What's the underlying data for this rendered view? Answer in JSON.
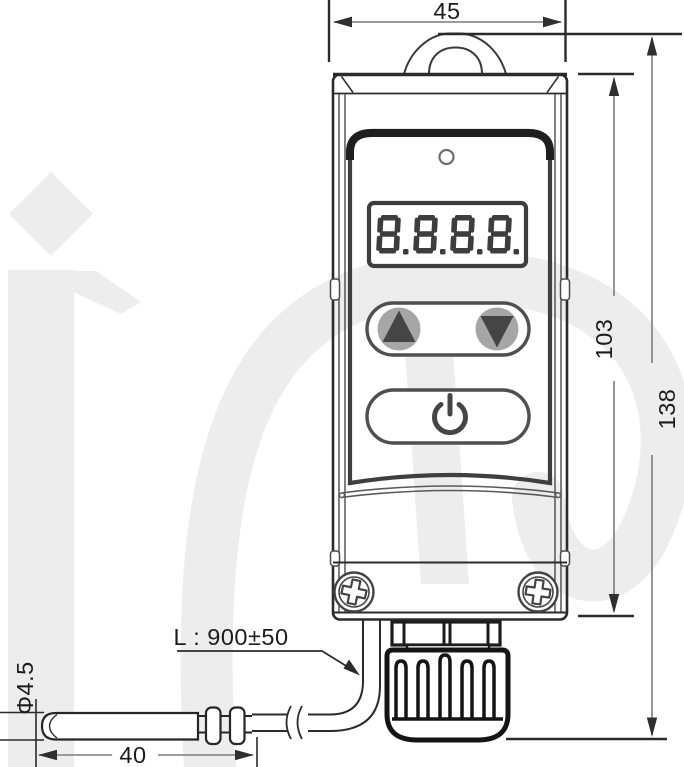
{
  "meta": {
    "type": "technical-dimension-drawing",
    "subject": "digital thermostat with remote sensor probe"
  },
  "dimensions": {
    "width": "45",
    "front_height": "103",
    "total_height": "138",
    "probe_length": "40",
    "probe_diameter": "Φ4.5",
    "cable_length": "L : 900±50"
  },
  "display": {
    "value": "8.8.8.8"
  },
  "controls": {
    "up": "up-arrow",
    "down": "down-arrow",
    "power": "power"
  },
  "icons": {
    "led": "led-indicator",
    "hanger": "mounting-hanger",
    "screws": "phillips-screws",
    "gland": "cable-gland",
    "probe": "sensor-probe",
    "watermark": "im-logo-watermark"
  },
  "colors": {
    "line": "#2b2b2b",
    "dimension_line": "#7c7c7c",
    "text": "#1c1c1c",
    "panel_dark": "#1f1f1f",
    "segment": "#3d3d3d",
    "button_fill": "#a6a6a6",
    "watermark": "#ededed"
  }
}
